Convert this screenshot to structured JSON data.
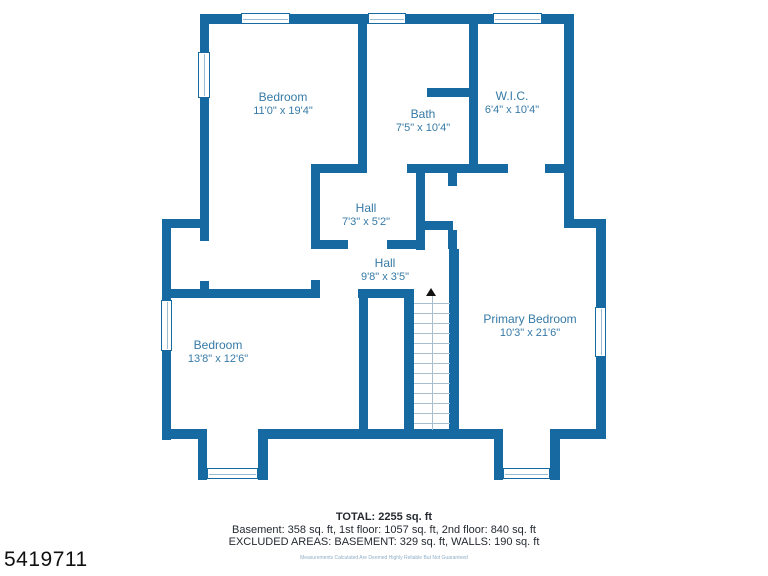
{
  "floorplan": {
    "rooms": [
      {
        "name": "Bedroom",
        "dims": "11'0\" x 19'4\""
      },
      {
        "name": "Bath",
        "dims": "7'5\" x 10'4\""
      },
      {
        "name": "W.I.C.",
        "dims": "6'4\" x 10'4\""
      },
      {
        "name": "Hall",
        "dims": "7'3\" x 5'2\""
      },
      {
        "name": "Hall",
        "dims": "9'8\" x 3'5\""
      },
      {
        "name": "Bedroom",
        "dims": "13'8\" x 12'6\""
      },
      {
        "name": "Primary Bedroom",
        "dims": "10'3\" x 21'6\""
      }
    ],
    "stairs": {
      "direction": "up"
    }
  },
  "summary": {
    "total": "TOTAL: 2255 sq. ft",
    "floors": "Basement: 358 sq. ft, 1st floor: 1057 sq. ft, 2nd floor: 840 sq. ft",
    "excluded": "EXCLUDED AREAS: BASEMENT: 329 sq. ft, WALLS: 190 sq. ft",
    "disclaimer": "Measurements Calculated Are Deemed Highly Reliable But Not Guaranteed"
  },
  "listing_id": "5419711",
  "colors": {
    "wall": "#1769a2",
    "room_label": "#367aa6",
    "summary_text": "#252a31",
    "tread_line": "#a9bfcd"
  }
}
